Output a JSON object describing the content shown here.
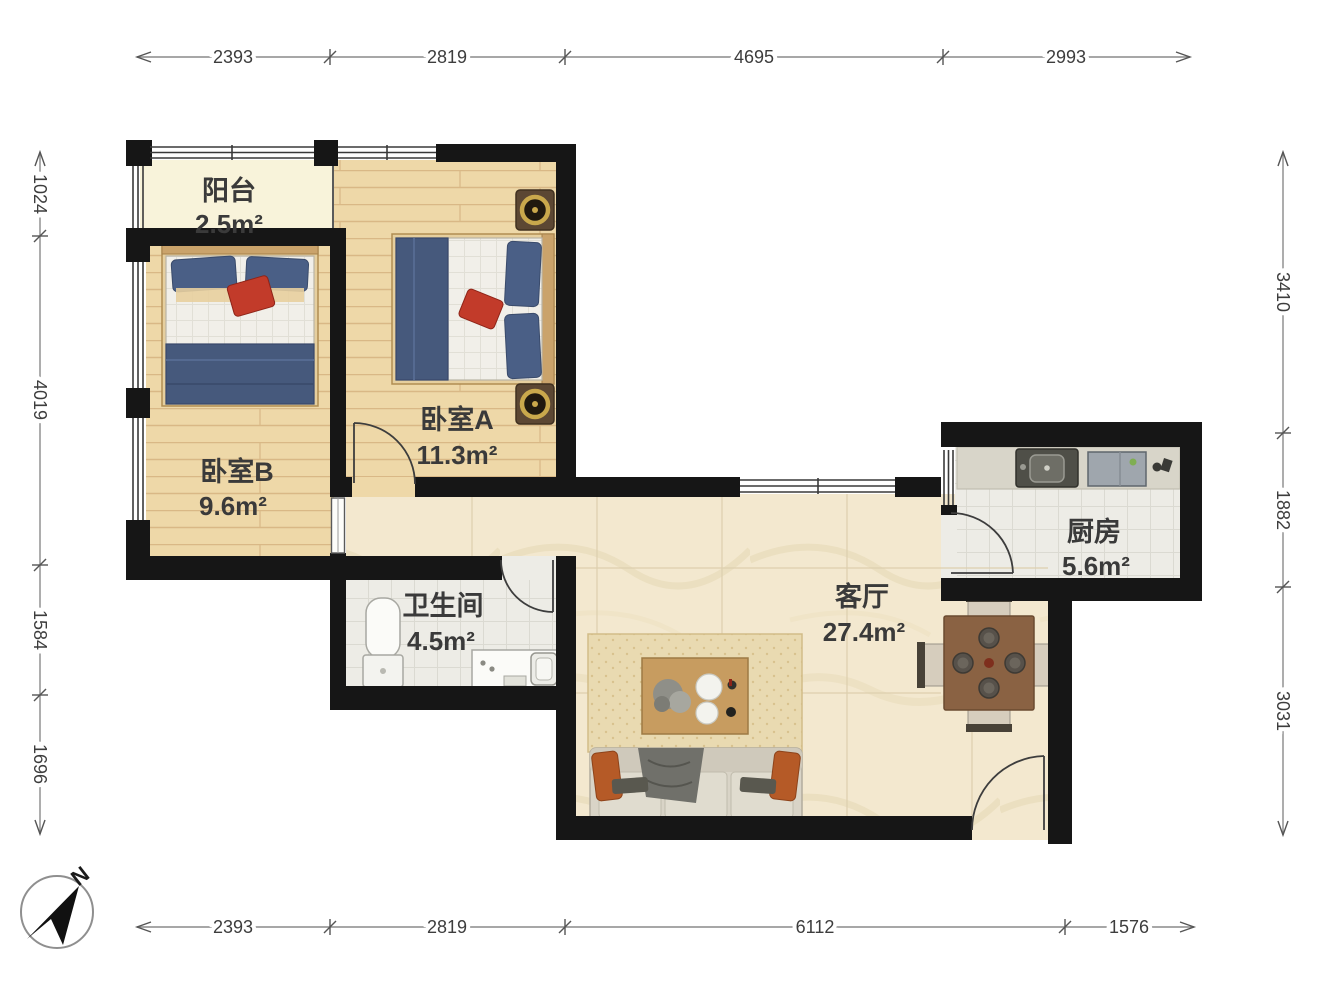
{
  "plan": {
    "type": "apartment-floor-plan",
    "rooms": {
      "balcony": {
        "name": "阳台",
        "area": "2.5m²"
      },
      "bedroom_a": {
        "name": "卧室A",
        "area": "11.3m²"
      },
      "bedroom_b": {
        "name": "卧室B",
        "area": "9.6m²"
      },
      "bathroom": {
        "name": "卫生间",
        "area": "4.5m²"
      },
      "living_room": {
        "name": "客厅",
        "area": "27.4m²"
      },
      "kitchen": {
        "name": "厨房",
        "area": "5.6m²"
      }
    },
    "dimensions_mm": {
      "top": [
        "2393",
        "2819",
        "4695",
        "2993"
      ],
      "bottom": [
        "2393",
        "2819",
        "6112",
        "1576"
      ],
      "left": [
        "1024",
        "4019",
        "1584",
        "1696"
      ],
      "right": [
        "3410",
        "1882",
        "3031"
      ]
    },
    "compass": {
      "north_label": "N"
    },
    "colors": {
      "wall": "#161616",
      "wood_floor": "#eed8a8",
      "marble_floor": "#f3e8cf",
      "tile_floor": "#edece6",
      "balcony_floor": "#f8f3da",
      "bed_blue": "#46597c",
      "accent_red": "#c23b2a",
      "sofa_pillow_orange": "#b55a27",
      "dining_wood": "#8a6243"
    }
  }
}
